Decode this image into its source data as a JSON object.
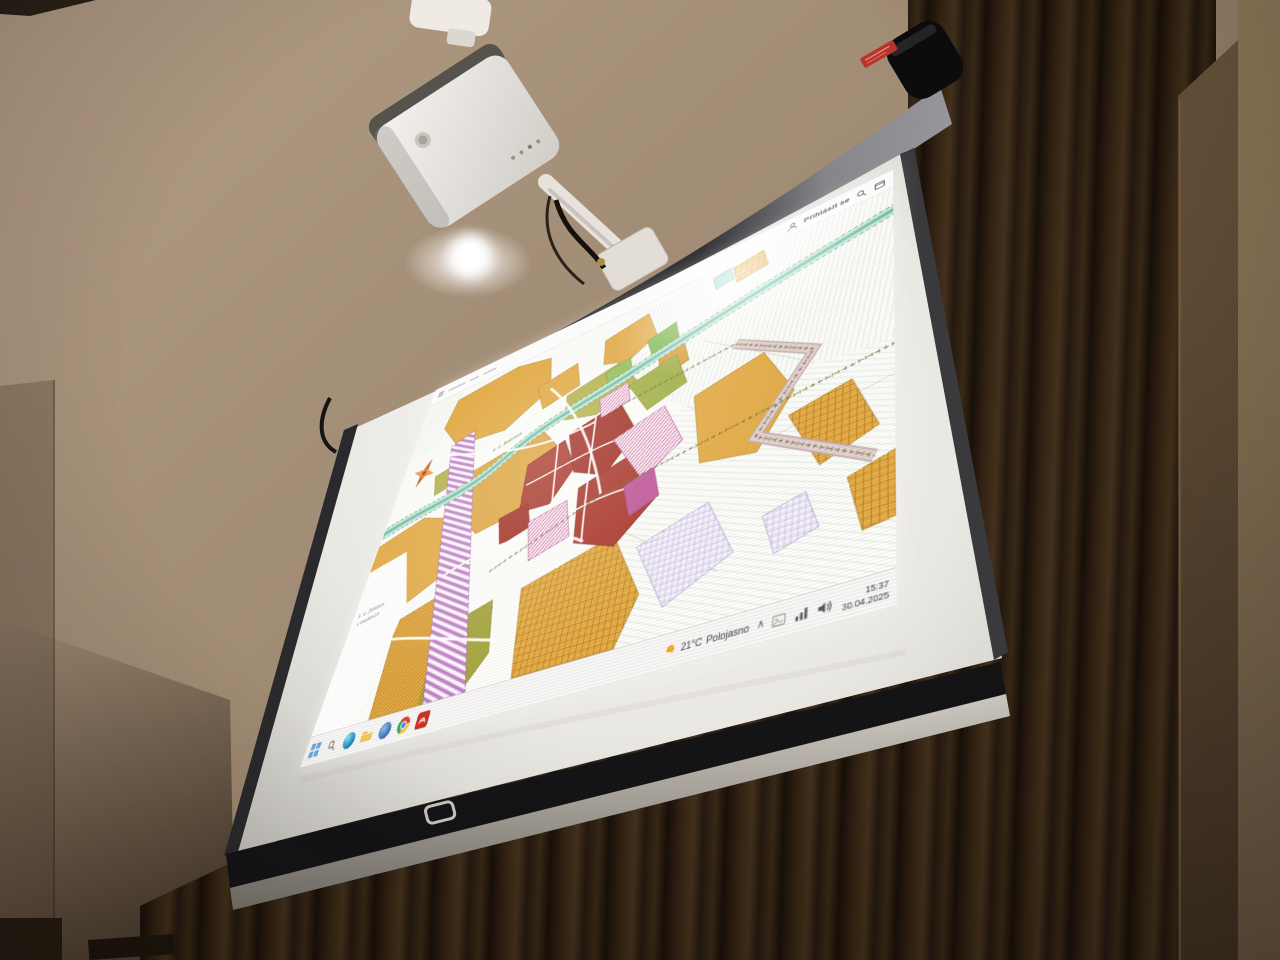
{
  "desktop": {
    "toolbar": {
      "signin_label": "Přihlásit se"
    },
    "taskbar": {
      "weather_temp": "21°C",
      "weather_condition": "Polojasno",
      "tray_chevron": "∧",
      "time": "15:37",
      "date": "30.04.2025",
      "app_icons": [
        "start",
        "edge",
        "file-explorer",
        "messenger",
        "chrome",
        "acrobat"
      ]
    },
    "map": {
      "labels": {
        "stream": "k. ú. Bobrava",
        "margin_line1": "k. ú. Želešice",
        "margin_line2": "v Modřicích"
      },
      "palette": {
        "agricultural_orange": "#e3a83e",
        "builtup_red": "#b03a2c",
        "mixed_pink": "#c4579a",
        "corridor_purple": "#bd7fc4",
        "river_teal": "#8fd0bf",
        "greenery_olive": "#b5b148",
        "road_pale_pink": "#e0cccc"
      }
    }
  },
  "room": {
    "screen_sticker_color": "#b8342a"
  }
}
